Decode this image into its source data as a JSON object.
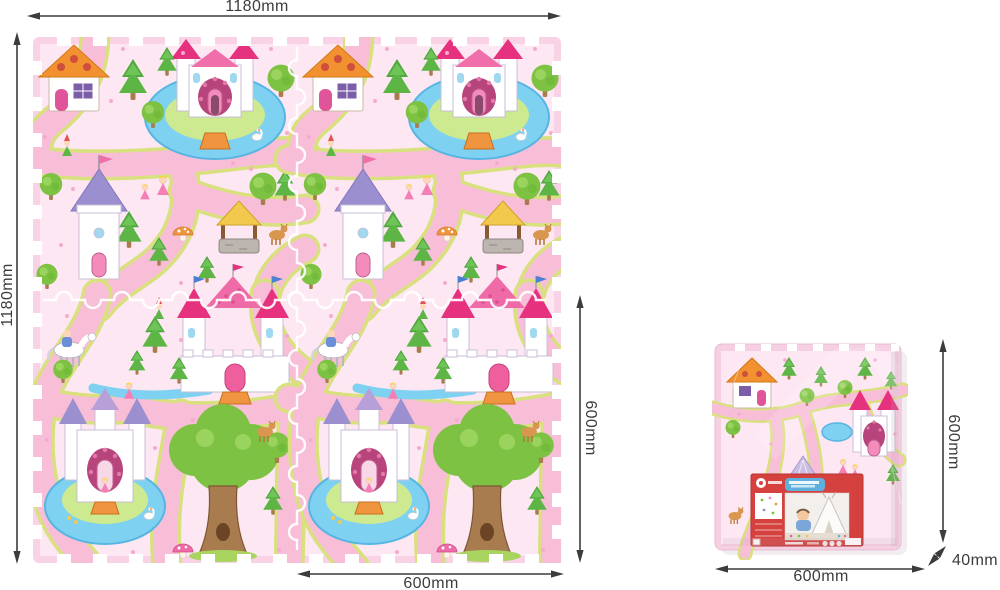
{
  "diagram": {
    "mat": {
      "width_label": "1180mm",
      "height_label": "1180mm",
      "tile_width_label": "600mm",
      "tile_height_label": "600mm",
      "grid": {
        "rows": 2,
        "cols": 2
      }
    },
    "package": {
      "width_label": "600mm",
      "height_label": "600mm",
      "thickness_label": "40mm"
    }
  },
  "colors": {
    "dimension_line": "#3c3c3c",
    "mat_edge": "#f9d2e6",
    "mat_background": "#fde7f3",
    "mat_path": "#f8bed8",
    "path_border": "#d9e07e",
    "water": "#7fd1f2",
    "foliage": "#7dc242",
    "pine": "#5cb544",
    "roof_pink": "#e6317f",
    "roof_purple": "#9c8fd0",
    "roof_orange": "#f29130",
    "package_label_red": "#d5413e",
    "package_label_blue": "#5fb0dc"
  }
}
